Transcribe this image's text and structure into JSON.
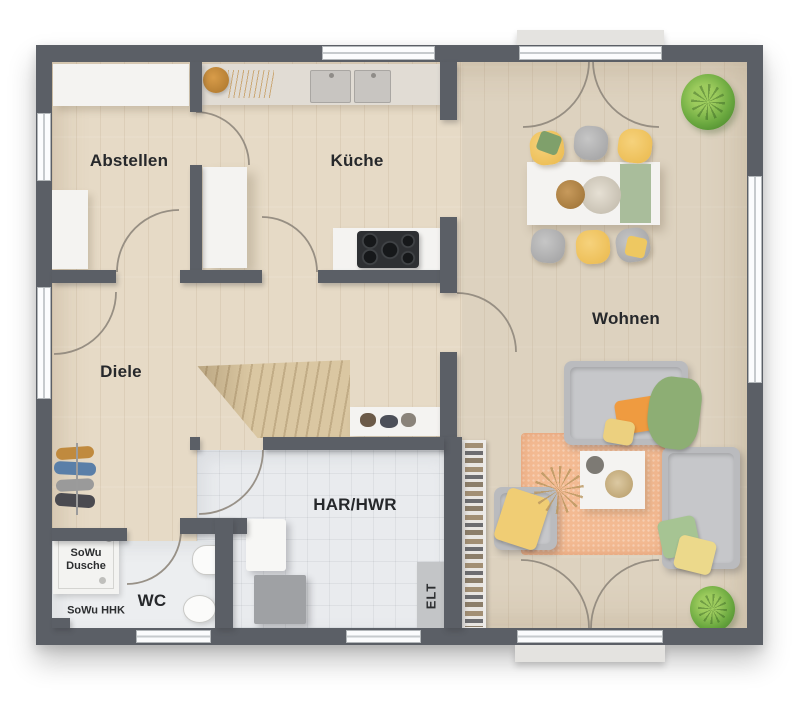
{
  "title": "floor-plan-ground-floor",
  "rooms": [
    {
      "id": "abstellen",
      "label": "Abstellen"
    },
    {
      "id": "kueche",
      "label": "Küche"
    },
    {
      "id": "wohnen",
      "label": "Wohnen"
    },
    {
      "id": "diele",
      "label": "Diele"
    },
    {
      "id": "har-hwr",
      "label": "HAR/HWR"
    },
    {
      "id": "wc",
      "label": "WC"
    }
  ],
  "annotations": {
    "shower": {
      "line1": "SoWu",
      "line2": "Dusche"
    },
    "heater": {
      "label": "SoWu HHK"
    },
    "electrical": {
      "label": "ELT"
    }
  },
  "fixtures": [
    "storage-shelf",
    "storage-cabinet",
    "kitchen-counter",
    "kitchen-sink-double",
    "tall-cabinet",
    "cooktop",
    "dining-table",
    "dining-chairs-6",
    "table-runner",
    "centerpiece-bowl",
    "sofa",
    "loveseat",
    "armchair",
    "coffee-table",
    "rug",
    "bookshelf",
    "floor-plant",
    "staircase",
    "wardrobe-rack",
    "shoe-shelf",
    "washing-machine",
    "utility-unit",
    "shower",
    "wash-basin",
    "toilet",
    "potted-plant-top",
    "potted-plant-bottom",
    "french-doors-top",
    "french-doors-bottom",
    "entrance-door",
    "windows"
  ],
  "palette": {
    "wall": "#5b5f66",
    "wood_floor": "#e6dac6",
    "tile_floor": "#e9ebee",
    "window_frame": "#fbfcfd",
    "door_arc": "#8f877c",
    "stairs_wood": "#dac7a2",
    "sofa_gray": "#babbbe",
    "accent_yellow": "#edbf58",
    "accent_orange": "#ef9b40",
    "accent_green": "#8fae77",
    "rug_peach": "#f3ba92"
  }
}
